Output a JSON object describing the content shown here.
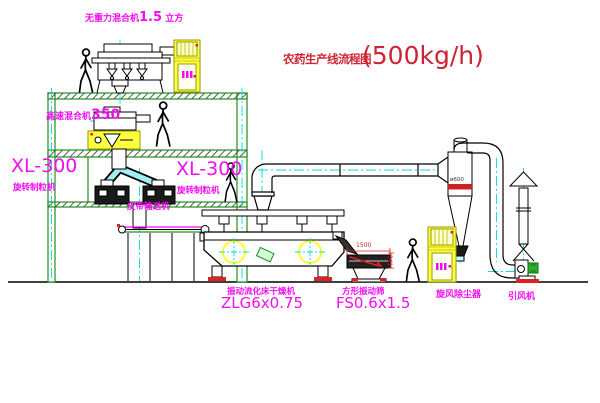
{
  "title": {
    "text": "农药生产线流程图",
    "capacity": "(500kg/h)"
  },
  "equipment_labels": {
    "gravity_free_mixer": {
      "name": "无重力混合机",
      "size": "1.5",
      "unit": "立方"
    },
    "high_speed_mixer": {
      "name": "高速混合机",
      "size": "350"
    },
    "granulator_left": {
      "model": "XL-300",
      "name": "旋转制粒机"
    },
    "granulator_right": {
      "model": "XL-300",
      "name": "旋转制粒机"
    },
    "belt_conveyor": {
      "name": "皮带输送机"
    },
    "fluid_bed_dryer": {
      "name": "振动流化床干燥机",
      "model": "ZLG6x0.75"
    },
    "vibrating_sieve": {
      "name": "方形振动筛",
      "model": "FS0.6x1.5"
    },
    "cyclone": {
      "name": "旋风除尘器",
      "dia": "ø600"
    },
    "fan": {
      "name": "引风机"
    }
  },
  "dimensions": {
    "sieve_width": "1500",
    "sieve_height": "341"
  },
  "colors": {
    "label_magenta": "#f00df0",
    "title_red": "#cf2233",
    "structure_green": "#1f8f1f",
    "centerline_cyan": "#00dddd",
    "highlight_yellow": "#ffff00",
    "dimension_red": "#dd2222",
    "cabinet_yellow": "#ffff42"
  }
}
